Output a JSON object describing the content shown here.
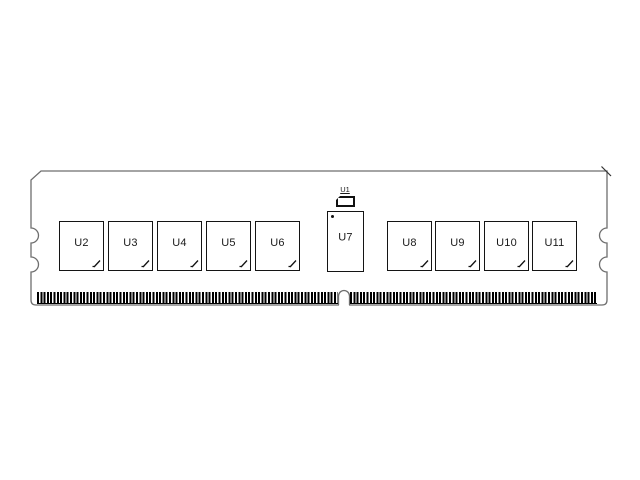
{
  "chips": {
    "top": "U1",
    "left": [
      "U2",
      "U3",
      "U4",
      "U5",
      "U6"
    ],
    "center": "U7",
    "right": [
      "U8",
      "U9",
      "U10",
      "U11"
    ]
  },
  "colors": {
    "outline": "#6e6e6e",
    "component": "#141414",
    "pins": "#000000",
    "background": "#ffffff"
  }
}
